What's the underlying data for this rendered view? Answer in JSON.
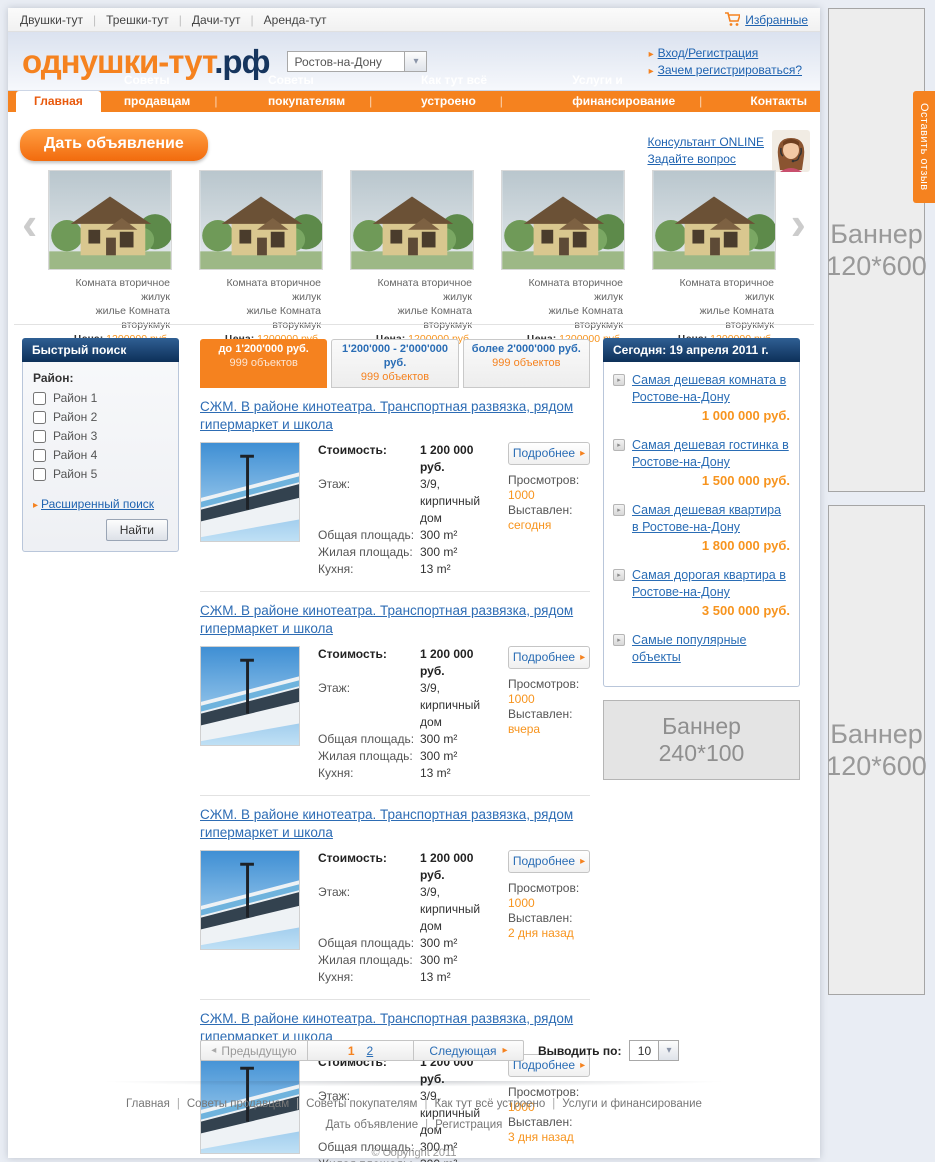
{
  "icons": {
    "bullet": "▸",
    "dropdown": "▾",
    "chevron_left": "‹",
    "chevron_right": "›",
    "prev_arrow": "◂",
    "next_arrow": "▸"
  },
  "top_bar": {
    "links": [
      "Двушки-тут",
      "Трешки-тут",
      "Дачи-тут",
      "Аренда-тут"
    ],
    "favorites": "Избранные"
  },
  "header": {
    "logo_main": "однушки-тут",
    "logo_suffix": ".рф",
    "city": "Ростов-на-Дону",
    "login_link": "Вход/Регистрация",
    "why_register_link": "Зачем регистрироваться?"
  },
  "nav": {
    "tabs": [
      {
        "label": "Главная",
        "active": true
      },
      {
        "label": "Советы продавцам"
      },
      {
        "label": "Советы покупателям"
      },
      {
        "label": "Как тут всё устроено"
      },
      {
        "label": "Услуги и финансирование"
      },
      {
        "label": "Контакты"
      }
    ]
  },
  "actions": {
    "post_ad": "Дать объявление",
    "consultant_line1": "Консультант ONLINE",
    "consultant_line2": "Задайте вопрос"
  },
  "carousel": {
    "items": [
      {
        "line1": "Комната вторичное жилук",
        "line2": "жилье Комната вторукмук",
        "price_label": "Цена:",
        "price": "1200000 руб."
      },
      {
        "line1": "Комната вторичное жилук",
        "line2": "жилье Комната вторукмук",
        "price_label": "Цена:",
        "price": "1200000 руб."
      },
      {
        "line1": "Комната вторичное жилук",
        "line2": "жилье Комната вторукмук",
        "price_label": "Цена:",
        "price": "1200000 руб."
      },
      {
        "line1": "Комната вторичное жилук",
        "line2": "жилье Комната вторукмук",
        "price_label": "Цена:",
        "price": "1200000 руб."
      },
      {
        "line1": "Комната вторичное жилук",
        "line2": "жилье Комната вторукмук",
        "price_label": "Цена:",
        "price": "1200000 руб."
      }
    ]
  },
  "quick_search": {
    "title": "Быстрый поиск",
    "district_label": "Район:",
    "districts": [
      "Район 1",
      "Район 2",
      "Район 3",
      "Район 4",
      "Район 5"
    ],
    "advanced_link": "Расширенный поиск",
    "find_button": "Найти"
  },
  "price_tabs": [
    {
      "range": "до 1'200'000 руб.",
      "count": "999 объектов",
      "active": true
    },
    {
      "range": "1'200'000 - 2'000'000 руб.",
      "count": "999 объектов"
    },
    {
      "range": "более 2'000'000 руб.",
      "count": "999 объектов"
    }
  ],
  "listings": {
    "items": [
      {
        "title": "СЖМ. В районе кинотеатра. Транспортная развязка, рядом гипермаркет и школа",
        "price_label": "Стоимость:",
        "price": "1 200 000 руб.",
        "floor_label": "Этаж:",
        "floor": "3/9, кирпичный дом",
        "total_label": "Общая площадь:",
        "total": "300 m²",
        "living_label": "Жилая площадь:",
        "living": "300 m²",
        "kitchen_label": "Кухня:",
        "kitchen": "13 m²",
        "details_button": "Подробнее",
        "views_label": "Просмотров:",
        "views": "1000",
        "posted_label": "Выставлен:",
        "posted": "сегодня"
      },
      {
        "title": "СЖМ. В районе кинотеатра. Транспортная развязка, рядом гипермаркет и школа",
        "price_label": "Стоимость:",
        "price": "1 200 000 руб.",
        "floor_label": "Этаж:",
        "floor": "3/9, кирпичный дом",
        "total_label": "Общая площадь:",
        "total": "300 m²",
        "living_label": "Жилая площадь:",
        "living": "300 m²",
        "kitchen_label": "Кухня:",
        "kitchen": "13 m²",
        "details_button": "Подробнее",
        "views_label": "Просмотров:",
        "views": "1000",
        "posted_label": "Выставлен:",
        "posted": "вчера"
      },
      {
        "title": "СЖМ. В районе кинотеатра. Транспортная развязка, рядом гипермаркет и школа",
        "price_label": "Стоимость:",
        "price": "1 200 000 руб.",
        "floor_label": "Этаж:",
        "floor": "3/9, кирпичный дом",
        "total_label": "Общая площадь:",
        "total": "300 m²",
        "living_label": "Жилая площадь:",
        "living": "300 m²",
        "kitchen_label": "Кухня:",
        "kitchen": "13 m²",
        "details_button": "Подробнее",
        "views_label": "Просмотров:",
        "views": "1000",
        "posted_label": "Выставлен:",
        "posted": "2 дня назад"
      },
      {
        "title": "СЖМ. В районе кинотеатра. Транспортная развязка, рядом гипермаркет и школа",
        "price_label": "Стоимость:",
        "price": "1 200 000 руб.",
        "floor_label": "Этаж:",
        "floor": "3/9, кирпичный дом",
        "total_label": "Общая площадь:",
        "total": "300 m²",
        "living_label": "Жилая площадь:",
        "living": "300 m²",
        "kitchen_label": "Кухня:",
        "kitchen": "13 m²",
        "details_button": "Подробнее",
        "views_label": "Просмотров:",
        "views": "1000",
        "posted_label": "Выставлен:",
        "posted": "3 дня назад"
      }
    ]
  },
  "today": {
    "title": "Сегодня: 19 апреля 2011 г.",
    "items": [
      {
        "text": "Самая дешевая комната в Ростове-на-Дону",
        "price": "1 000 000 руб."
      },
      {
        "text": "Самая дешевая гостинка в Ростове-на-Дону",
        "price": "1 500 000 руб."
      },
      {
        "text": "Самая дешевая квартира в Ростове-на-Дону",
        "price": "1 800 000 руб."
      },
      {
        "text": "Самая дорогая квартира в Ростове-на-Дону",
        "price": "3 500 000 руб."
      },
      {
        "text": "Самые популярные объекты",
        "price": ""
      }
    ]
  },
  "banners": {
    "inline_line1": "Баннер",
    "inline_line2": "240*100",
    "side_line1": "Баннер",
    "side_line2": "120*600"
  },
  "feedback_tab": "Оставить отзыв",
  "pagination": {
    "prev": "Предыдущую",
    "page_1": "1",
    "page_2": "2",
    "next": "Следующая",
    "per_page_label": "Выводить по:",
    "per_page": "10"
  },
  "footer": {
    "links_row1": [
      "Главная",
      "Советы продавцам",
      "Советы покупателям",
      "Как тут всё устроено",
      "Услуги и финансирование"
    ],
    "links_row2": [
      "Дать объявление",
      "Регистрация"
    ],
    "copyright": "© Copyright 2011"
  }
}
